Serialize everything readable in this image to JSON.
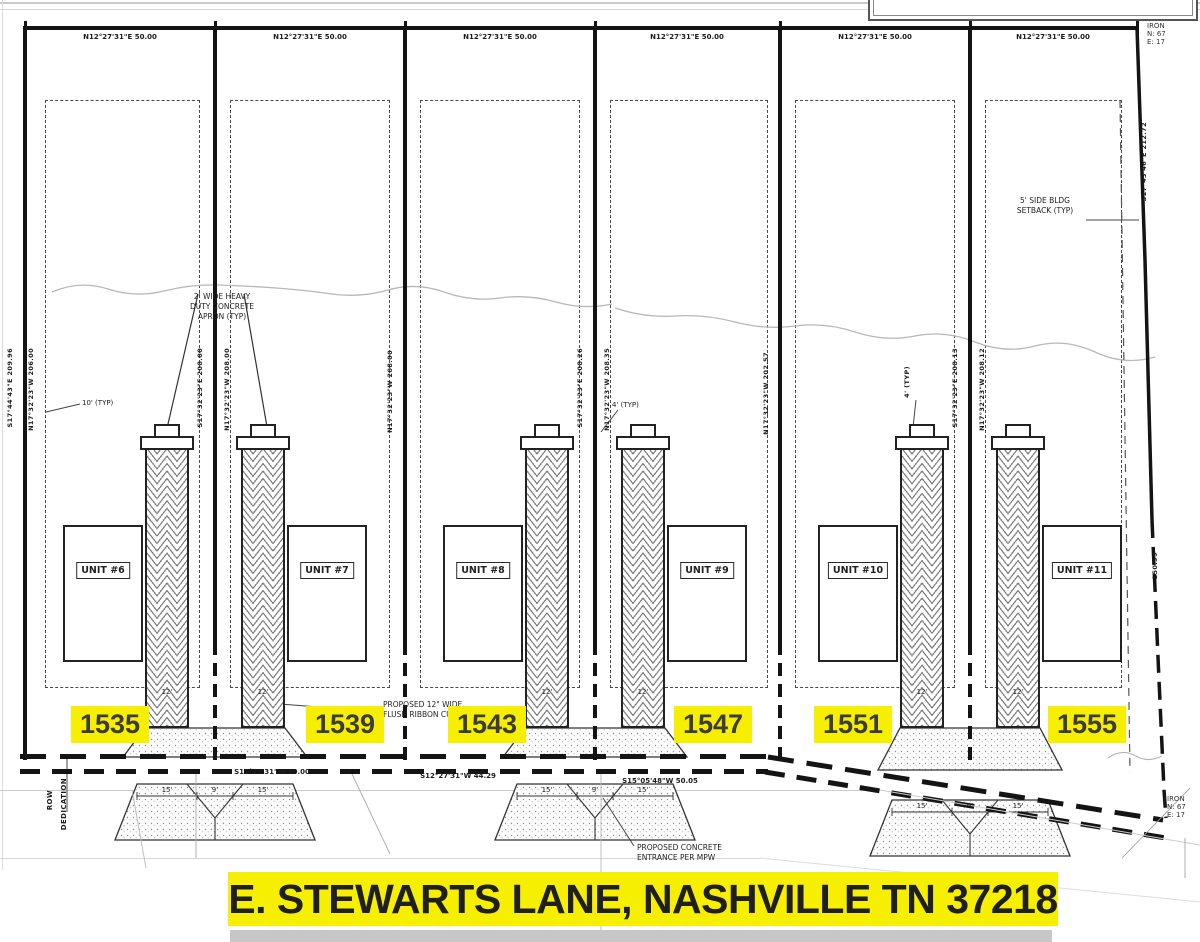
{
  "colors": {
    "highlight": "#f7ef00",
    "line": "#141414"
  },
  "title": {
    "text": "E. STEWARTS LANE, NASHVILLE TN 37218"
  },
  "addresses": [
    "1535",
    "1539",
    "1543",
    "1547",
    "1551",
    "1555"
  ],
  "units": [
    "UNIT #6",
    "UNIT #7",
    "UNIT #8",
    "UNIT #9",
    "UNIT #10",
    "UNIT #11"
  ],
  "boundary": {
    "top_bearings": [
      "N12°27'31\"E  50.00",
      "N12°27'31\"E  50.00",
      "N12°27'31\"E  50.00",
      "N12°27'31\"E  50.00",
      "N12°27'31\"E  50.00",
      "N12°27'31\"E  50.00"
    ],
    "bottom_bearings": [
      "S12°27'31\"W  50.00",
      "S12°27'31\"W  44.29",
      "S15°05'48\"W  50.05"
    ],
    "iron_marker": [
      "IRON",
      "N: 67",
      "E: 17"
    ]
  },
  "side_labels": {
    "rotated": [
      "S17°44'43\"E  209.96",
      "N17°32'23\"W  206.00",
      "S17°32'23\"E  208.00",
      "N17°32'23\"W  208.00",
      "N17°32'23\"W  208.00",
      "S17°32'23\"E  208.26",
      "N17°32'23\"W  208.35",
      "N17°32'23\"W  202.57",
      "S17°32'23\"E  208.13",
      "N17°32'23\"W  208.12",
      "S17°43'46\"E  212.72",
      "150.99",
      "4' (TYP)"
    ]
  },
  "callouts": {
    "apron": [
      "2' WIDE HEAVY",
      "DUTY CONCRETE",
      "APRON (TYP)"
    ],
    "ribbon_curb": [
      "PROPOSED 12\" WIDE",
      "FLUSH RIBBON CURB (TYP)"
    ],
    "entrance": [
      "PROPOSED CONCRETE",
      "ENTRANCE PER MPW"
    ],
    "side_setback": [
      "5' SIDE BLDG",
      "SETBACK (TYP)"
    ],
    "offset_10": "10' (TYP)",
    "offset_4": "4' (TYP)"
  },
  "dims": {
    "drive_width": "12'",
    "entrance_widths": [
      "15'",
      "9'",
      "15'"
    ]
  },
  "row_label": [
    "ROW",
    "DEDICATION"
  ]
}
